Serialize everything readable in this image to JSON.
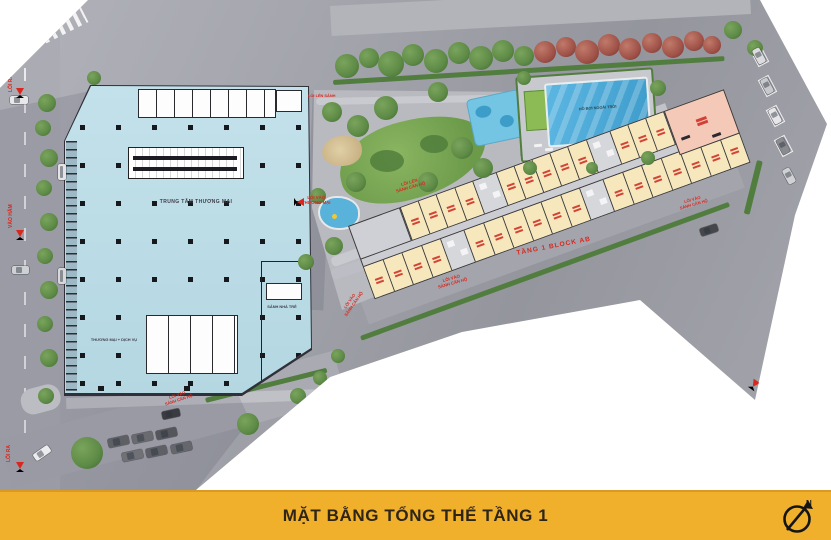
{
  "footer": {
    "title": "MẶT BẰNG TỔNG THỂ TẦNG 1",
    "compass_letter": "N",
    "bar_color": "#F0B02C",
    "text_color": "#2E2517"
  },
  "mall": {
    "title": "TRUNG TÂM THƯƠNG MẠI",
    "zone_commercial": "THƯƠNG MẠI + DỊCH VỤ",
    "zone_kindergarten_lobby": "SẢNH NHÀ TRẺ",
    "fill_color": "#BEDFE8"
  },
  "block_ab": {
    "road_label": "TẦNG 1 BLOCK AB",
    "unit_fill_color": "#F6E7BD",
    "end_unit_color": "#F4C9B8",
    "top_row_units": 12,
    "bottom_row_units": 17
  },
  "amenities": {
    "pool_label": "HỒ BƠI NGOÀI TRỜI",
    "pool_color": "#45A6D6",
    "lawn_color": "#8CBB55"
  },
  "entrances": {
    "exit": "LỐI RA",
    "basement_entry": "VÀO HẦM",
    "mall_entry_l1": "LỐI VÀO",
    "mall_entry_l2": "THƯƠNG MẠI",
    "lobby_up": "LỐI LÊN SẢNH",
    "apt_up_l1": "LỐI LÊN",
    "apt_up_l2": "SẢNH CĂN HỘ",
    "apt_entry_l1": "LỐI VÀO",
    "apt_entry_l2": "SẢNH CĂN HỘ"
  },
  "marker_color": "#D8281E"
}
